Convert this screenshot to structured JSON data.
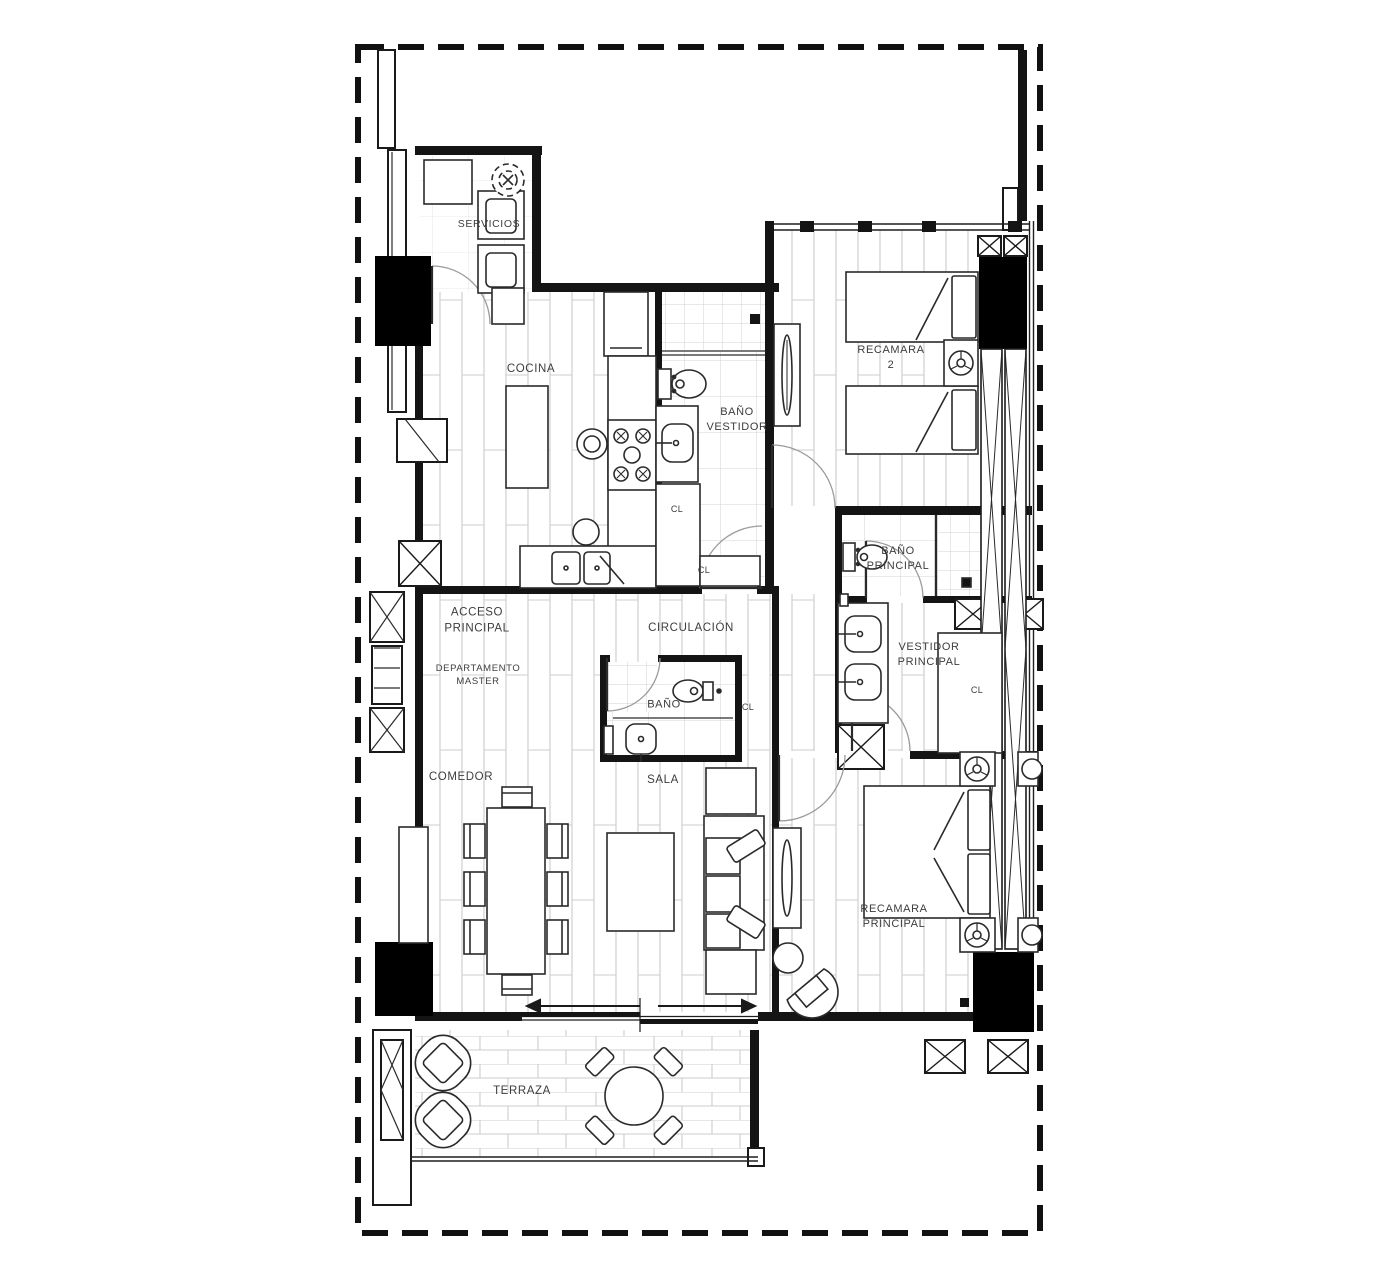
{
  "colors": {
    "boundary": "#111111",
    "wall": "#141414",
    "furniture_line": "#2a2a2a",
    "hatch": "#cccccc",
    "label_text": "#3d3d3d"
  },
  "labels": {
    "servicios": "SERVICIOS",
    "cocina": "COCINA",
    "bano_vestidor_1": "BAÑO",
    "bano_vestidor_2": "VESTIDOR",
    "recamara2_1": "RECAMARA",
    "recamara2_2": "2",
    "bano_principal_1": "BAÑO",
    "bano_principal_2": "PRINCIPAL",
    "acceso_1": "ACCESO",
    "acceso_2": "PRINCIPAL",
    "departamento_1": "DEPARTAMENTO",
    "departamento_2": "MASTER",
    "circulacion": "CIRCULACIÓN",
    "bano": "BAÑO",
    "vestidor_1": "VESTIDOR",
    "vestidor_2": "PRINCIPAL",
    "comedor": "COMEDOR",
    "sala": "SALA",
    "recamara_principal_1": "RECAMARA",
    "recamara_principal_2": "PRINCIPAL",
    "terraza": "TERRAZA",
    "closet": "CL"
  }
}
